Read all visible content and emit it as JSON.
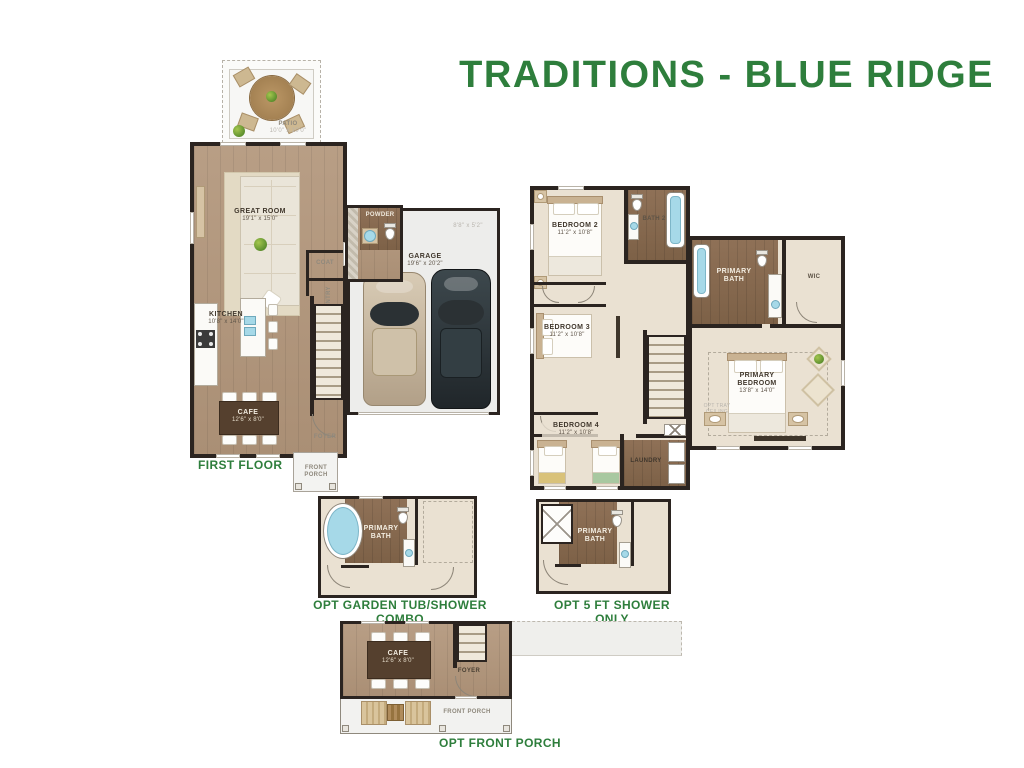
{
  "title": "TRADITIONS - BLUE RIDGE",
  "colors": {
    "accent_green": "#2E7E3C",
    "wall": "#2B2420",
    "wood": "#B59B81",
    "wood_dark": "#8A6E55",
    "carpet": "#EAE1D2",
    "garage_floor": "#EDEDEB",
    "water": "#A6D9E8"
  },
  "first_floor": {
    "label": "FIRST FLOOR",
    "rooms": {
      "patio": {
        "name": "PATIO",
        "dim": "10'0\" x 10'0\""
      },
      "great_room": {
        "name": "GREAT ROOM",
        "dim": "19'1\" x 15'0\""
      },
      "kitchen": {
        "name": "KITCHEN",
        "dim": "10'8\" x 14'0\""
      },
      "cafe": {
        "name": "CAFE",
        "dim": "12'6\" x 8'0\""
      },
      "powder": {
        "name": "POWDER"
      },
      "coat": {
        "name": "COAT"
      },
      "pantry": {
        "name": "PANTRY"
      },
      "foyer": {
        "name": "FOYER"
      },
      "garage": {
        "name": "GARAGE",
        "dim": "19'6\" x 20'2\""
      },
      "garage_note": "8'8\" x 5'2\"",
      "front_porch": {
        "name": "FRONT PORCH"
      }
    }
  },
  "second_floor": {
    "rooms": {
      "bedroom2": {
        "name": "BEDROOM 2",
        "dim": "11'2\" x 10'8\""
      },
      "bath2": {
        "name": "BATH 2"
      },
      "bedroom3": {
        "name": "BEDROOM 3",
        "dim": "11'2\" x 10'8\""
      },
      "bedroom4": {
        "name": "BEDROOM 4",
        "dim": "11'2\" x 10'8\""
      },
      "laundry": {
        "name": "LAUNDRY"
      },
      "primary_bath": {
        "name": "PRIMARY BATH"
      },
      "wic": {
        "name": "WIC"
      },
      "primary_bedroom": {
        "name": "PRIMARY BEDROOM",
        "dim": "13'8\" x 14'0\"",
        "note": "OPT TRAY CEILING"
      }
    }
  },
  "options": {
    "garden_tub": {
      "label": "OPT GARDEN TUB/SHOWER COMBO",
      "room": "PRIMARY BATH"
    },
    "shower_only": {
      "label": "OPT 5 FT SHOWER ONLY",
      "room": "PRIMARY BATH"
    },
    "front_porch": {
      "label": "OPT FRONT PORCH",
      "rooms": {
        "cafe": {
          "name": "CAFE",
          "dim": "12'6\" x 8'0\""
        },
        "foyer": "FOYER",
        "porch": "FRONT PORCH"
      }
    }
  }
}
